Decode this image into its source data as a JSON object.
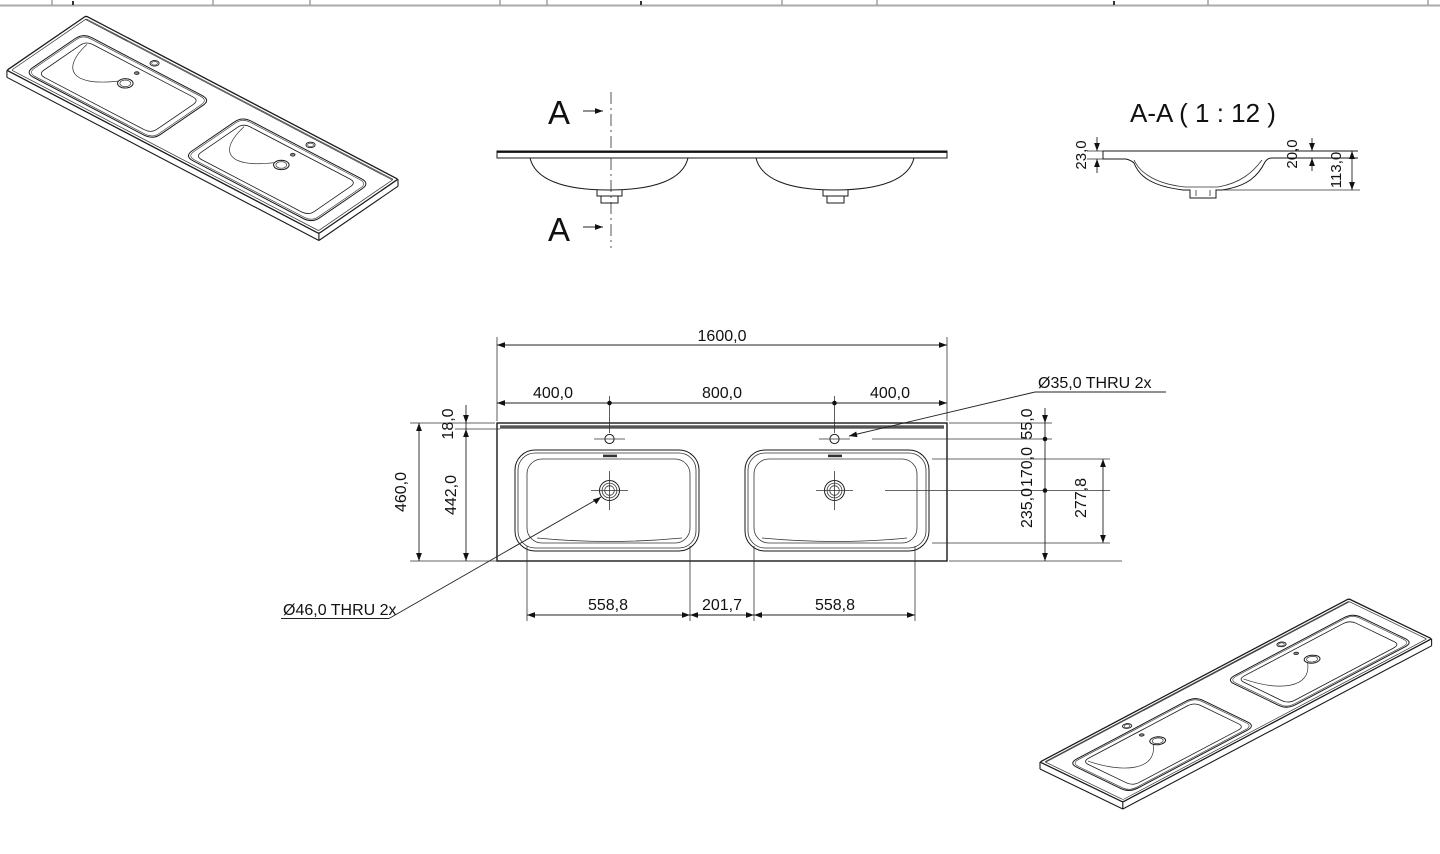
{
  "section": {
    "title": "A-A ( 1 : 12 )",
    "dims": {
      "lip": "23,0",
      "deck": "20,0",
      "height": "113,0"
    }
  },
  "elevation": {
    "cut_label_top": "A",
    "cut_label_bottom": "A"
  },
  "plan": {
    "dims": {
      "overall_width": "1600,0",
      "faucet_left": "400,0",
      "faucet_span": "800,0",
      "faucet_right": "400,0",
      "edge": "18,0",
      "depth": "460,0",
      "depth_inner": "442,0",
      "faucet_front": "55,0",
      "faucet_drain": "170,0",
      "drain_back": "235,0",
      "bowl_depth": "277,8",
      "bowl_left": "558,8",
      "bowl_gap": "201,7",
      "bowl_right": "558,8"
    },
    "callouts": {
      "drain": "Ø46,0 THRU 2x",
      "faucet": "Ø35,0 THRU 2x"
    }
  },
  "colors": {
    "line": "#1a1a1a",
    "band": "#555555",
    "frame": "#9a9a9a"
  }
}
